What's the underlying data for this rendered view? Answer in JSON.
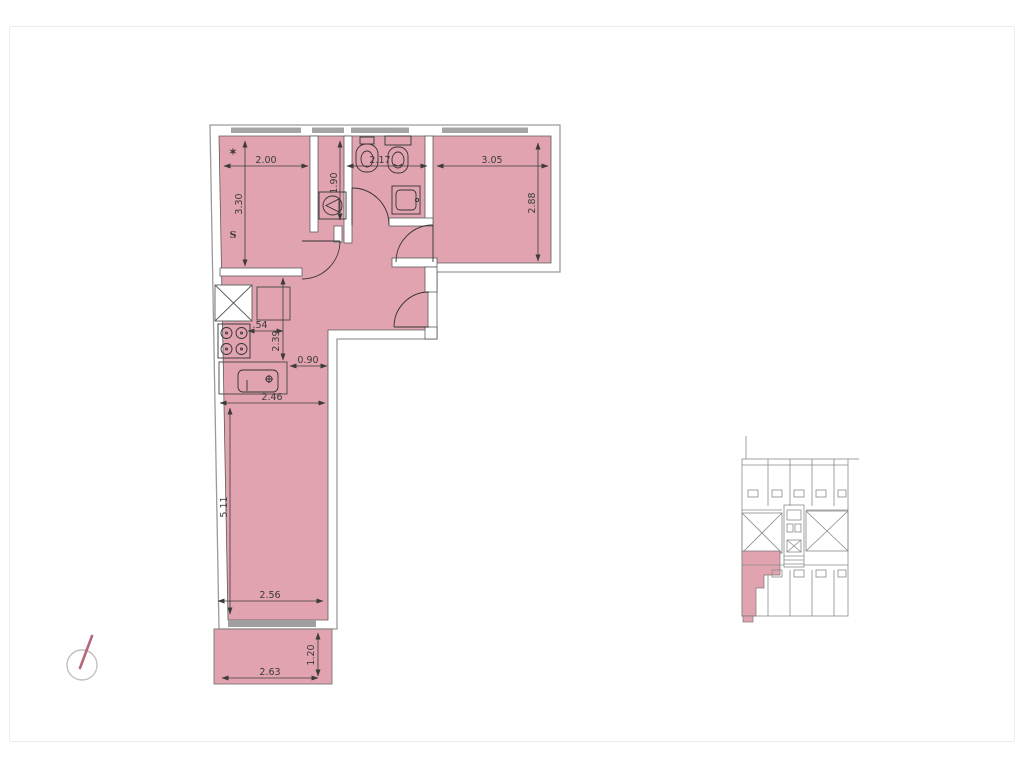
{
  "palette": {
    "unit_fill": "#e1a3af",
    "wall_outline": "#9a9a9a",
    "inner_line": "#5c5c5c",
    "fixture_line": "#333333",
    "dim_color": "#3b3b3b",
    "window_sill": "#a5a5a5",
    "keyplan_line": "#8a8a8a",
    "keyplan_unit_fill": "#e1a3af",
    "north_circle": "#c6bec0",
    "north_needle": "#b4687a",
    "watermark": "rgba(255,255,255,0.55)"
  },
  "floor_plan": {
    "dims": {
      "room1_width": "2.00",
      "bath_width": "2.17",
      "room2_width": "3.05",
      "room1_depth": "3.30",
      "laundry_depth": "1.90",
      "room2_depth": "2.88",
      "counter_width": ".54",
      "kitchen_depth": "2.39",
      "kitchen_pass": "0.90",
      "living_width_top": "2.46",
      "living_depth": "5.11",
      "living_width_bottom": "2.56",
      "balcony_depth": "1.20",
      "balcony_width": "2.63"
    },
    "watermark_letter": "S",
    "watermark_star": "✶"
  }
}
